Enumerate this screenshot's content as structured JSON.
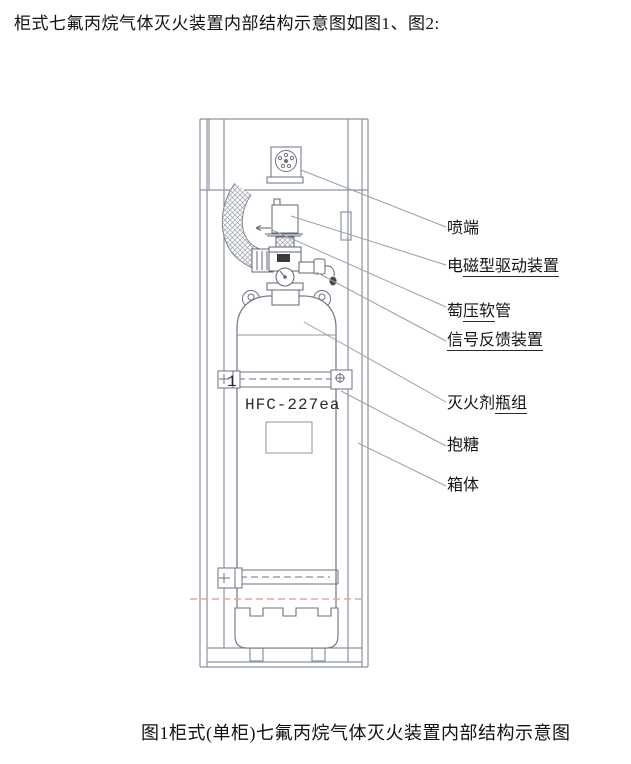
{
  "document": {
    "title": "柜式七氟丙烷气体灭火装置内部结构示意图如图1、图2:",
    "caption": "图1柜式(单柜)七氟丙烷气体灭火装置内部结构示意图"
  },
  "diagram": {
    "cylinder_text": "HFC-227ea",
    "marker": "1",
    "labels": [
      {
        "name": "nozzle",
        "pre": "喷端",
        "und": "",
        "post": ""
      },
      {
        "name": "solenoid-drive",
        "pre": "电",
        "und": "磁型驱动装置",
        "post": ""
      },
      {
        "name": "pressure-hose",
        "pre": "萄",
        "und": "压软",
        "post": "管"
      },
      {
        "name": "signal-feedback",
        "pre": "",
        "und": "信号反馈装置",
        "post": ""
      },
      {
        "name": "agent-cylinder-group",
        "pre": "灭火剂",
        "und": "瓶组",
        "post": ""
      },
      {
        "name": "clamp-band",
        "pre": "抱糖",
        "und": "",
        "post": ""
      },
      {
        "name": "cabinet-body",
        "pre": "箱体",
        "und": "",
        "post": ""
      }
    ],
    "colors": {
      "cabinet_line": "#8b93a1",
      "device_line": "#5f6670",
      "leader_line": "#9aa1ab",
      "ink": "#141414",
      "fold_mark_dashed": "#e6a79c"
    }
  }
}
